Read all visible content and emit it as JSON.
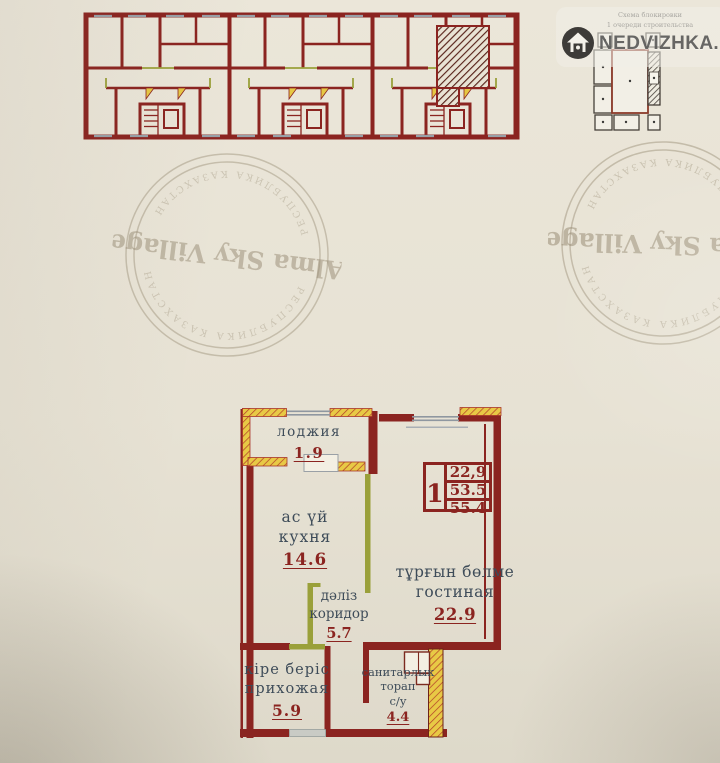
{
  "watermark": {
    "brand": "NEDVIZHKA.KZ",
    "logo_icon": "house-icon"
  },
  "site_plan": {
    "caption_line1": "Схема блокировки",
    "caption_line2": "1 очереди строительства"
  },
  "stamps": {
    "left": {
      "title": "Alma Sky Village",
      "ring_text": "РЕСПУБЛИКА КАЗАХСТАН"
    },
    "right": {
      "title": "Alma Sky Village",
      "ring_text": "РЕСПУБЛИКА КАЗАХСТАН"
    }
  },
  "floor_plan": {
    "rooms": {
      "loggia": {
        "line1": "лоджия",
        "area": "1.9"
      },
      "kitchen": {
        "line1": "ас үй",
        "line2": "кухня",
        "area": "14.6"
      },
      "living": {
        "line1": "тұрғын бөлме",
        "line2": "гостиная",
        "area": "22.9"
      },
      "corridor": {
        "line1": "дәліз",
        "line2": "коридор",
        "area": "5.7"
      },
      "entry": {
        "line1": "кіре беріс",
        "line2": "прихожая",
        "area": "5.9"
      },
      "bathroom": {
        "line1": "санитарлык",
        "line2": "торап",
        "line3": "с/у",
        "area": "4.4"
      }
    },
    "info_table": {
      "rooms": "1",
      "living_area": "22,9",
      "reduced_area": "53.5",
      "total_area": "55.4"
    }
  },
  "colors": {
    "wall_red": "#8b2420",
    "partition_olive": "#9aa03a",
    "loggia_yellow": "#e8c945",
    "window_gray": "#8f97a0",
    "label_text": "#3e4c59",
    "area_text": "#8b2420"
  }
}
